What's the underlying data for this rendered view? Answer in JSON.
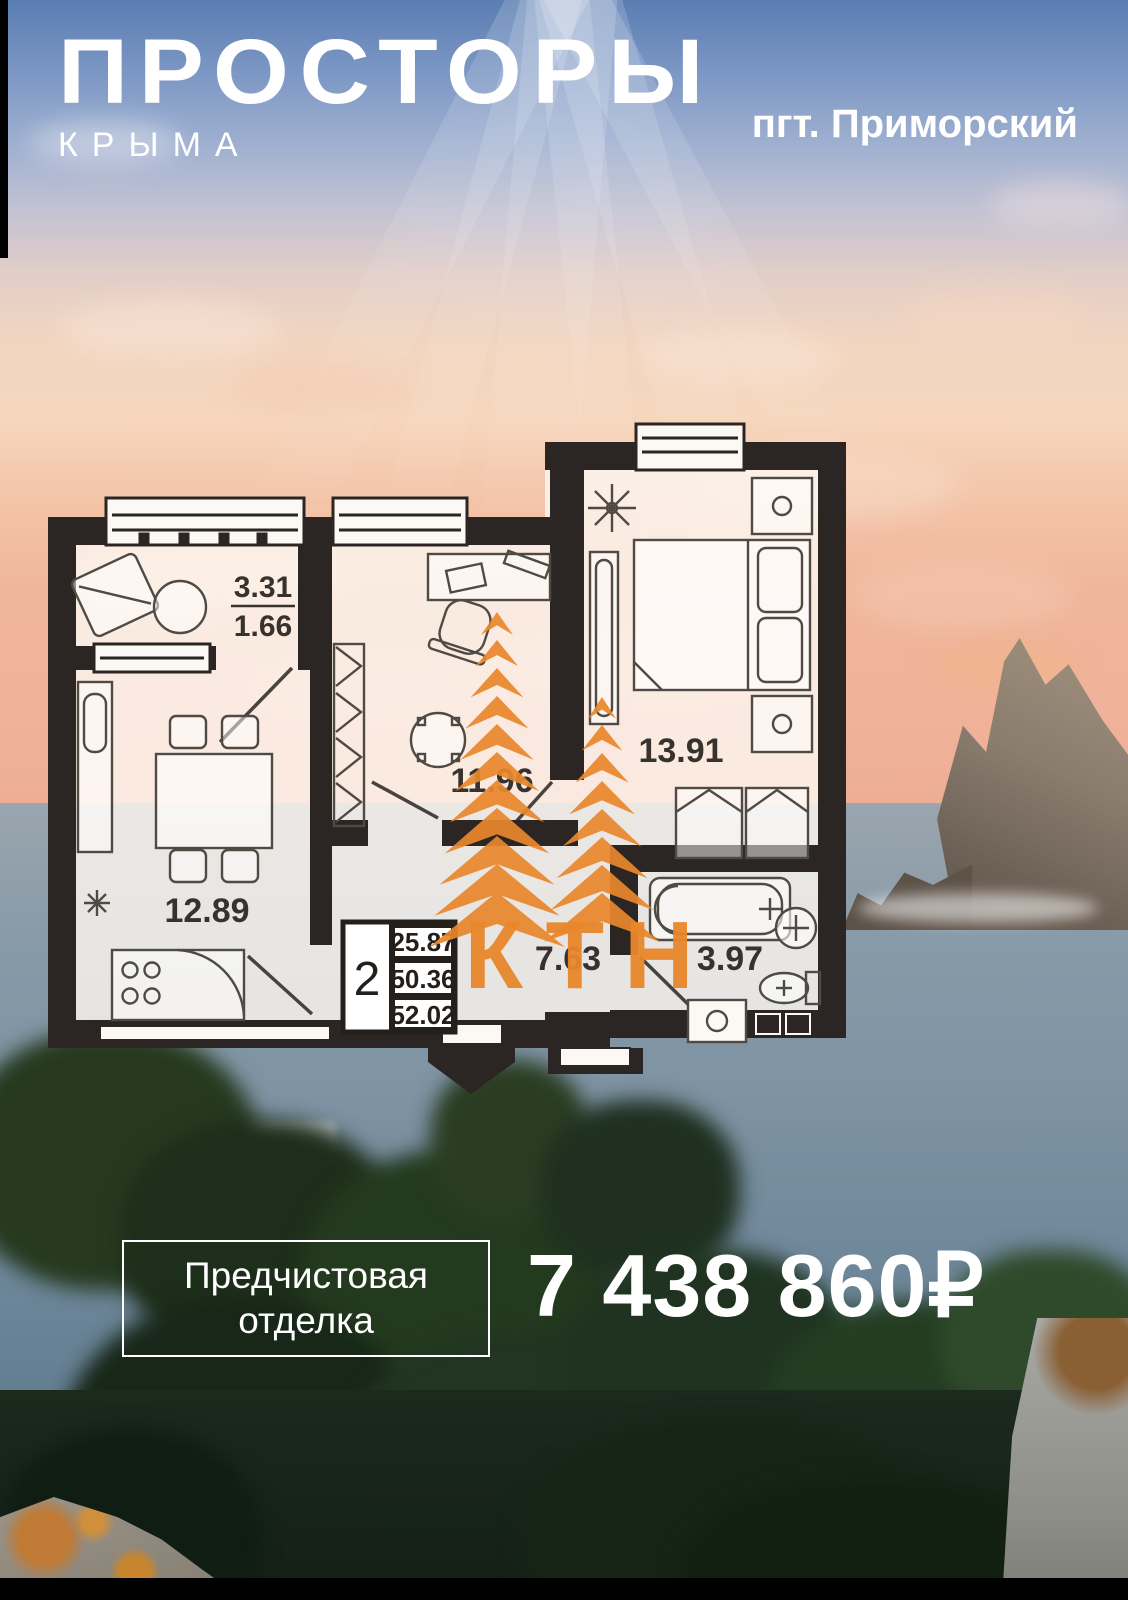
{
  "header": {
    "logo_title": "ПРОСТОРЫ",
    "logo_subtitle": "КРЫМА",
    "location": "пгт. Приморский"
  },
  "floorplan": {
    "rooms": [
      {
        "id": "balcony",
        "area": "3.31",
        "area_reduced": "1.66"
      },
      {
        "id": "kitchen",
        "area": "12.89"
      },
      {
        "id": "living-room",
        "area": "11.96"
      },
      {
        "id": "bedroom",
        "area": "13.91"
      },
      {
        "id": "hallway",
        "area": "7.63"
      },
      {
        "id": "bathroom",
        "area": "3.97"
      }
    ],
    "summary": {
      "rooms_count": "2",
      "living_area": "25.87",
      "area_without_balcony": "50.36",
      "total_area": "52.02"
    }
  },
  "watermark": {
    "text": "КТН",
    "color": "#E9872C"
  },
  "offer": {
    "finish_line1": "Предчистовая",
    "finish_line2": "отделка",
    "price": "7 438 860",
    "currency": "₽"
  }
}
